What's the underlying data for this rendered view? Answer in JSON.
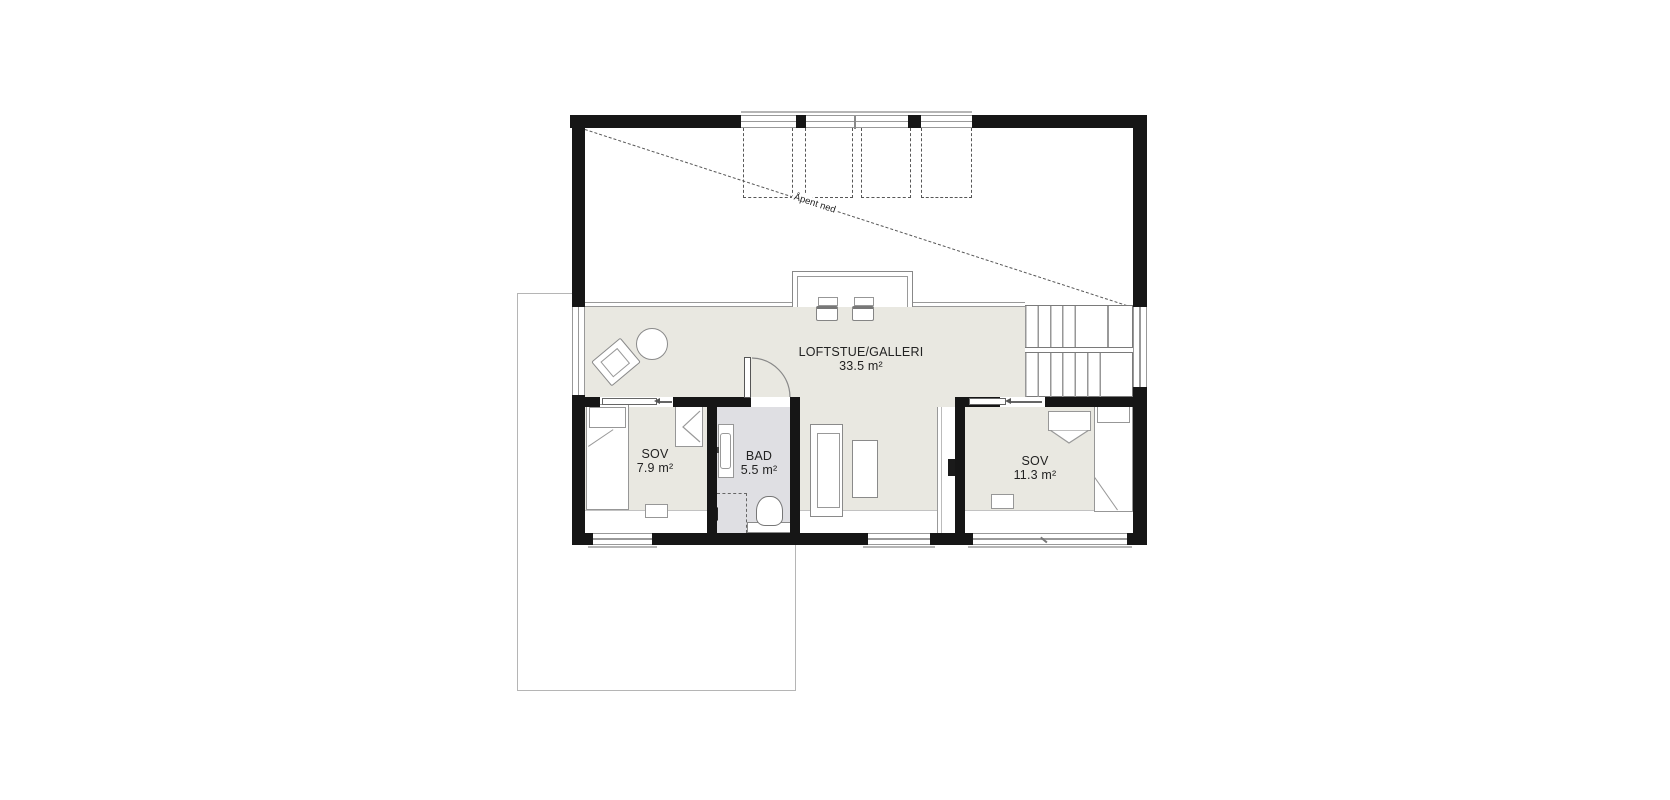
{
  "plan": {
    "type": "floor-plan-loft-level",
    "rooms": [
      {
        "name": "LOFTSTUE/GALLERI",
        "area": "33.5 m²"
      },
      {
        "name": "SOV",
        "area": "7.9 m²"
      },
      {
        "name": "BAD",
        "area": "5.5 m²"
      },
      {
        "name": "SOV",
        "area": "11.3 m²"
      }
    ],
    "annotations": {
      "open_to_below": "Åpent ned"
    },
    "features": {
      "stairs": "switchback-two-flights-with-landing",
      "skylights_dashed": 4,
      "balcony_rail_chairs": 2
    },
    "colors": {
      "wall": "#161616",
      "floor_main": "#e9e8e1",
      "floor_bath": "#dfdfe3",
      "line": "#8a8a8a",
      "dashed_line": "#575757",
      "background": "#ffffff"
    }
  }
}
